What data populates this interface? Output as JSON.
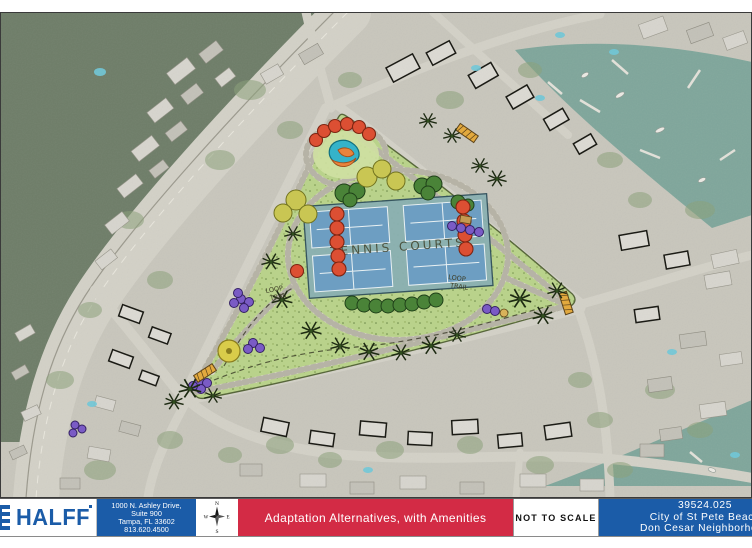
{
  "colors": {
    "brand_blue": "#1b5ca8",
    "banner_red": "#d32b45",
    "park_green": "#b9d28b",
    "water_teal": "#7fa69b",
    "court_blue": "#6d9ec2"
  },
  "map": {
    "tennis_courts_label": "TENNIS COURTS",
    "loop_trail_west": {
      "word1": "LOOP",
      "word2": "TRAIL"
    },
    "loop_trail_east": {
      "word1": "LOOP",
      "word2": "TRAIL"
    }
  },
  "title_block": {
    "logo_text": "HALFF",
    "address_lines": [
      "1000 N. Ashley Drive,",
      "Suite 900",
      "Tampa, FL 33602",
      "813.620.4500"
    ],
    "compass": {
      "north": "N",
      "east": "E",
      "south": "S",
      "west": "W"
    },
    "banner_title": "Adaptation Alternatives, with Amenities",
    "scale_note": "NOT TO SCALE",
    "project_number": "39524.025",
    "client": "City of St Pete Beach",
    "project_name": "Don Cesar Neighborhood"
  }
}
